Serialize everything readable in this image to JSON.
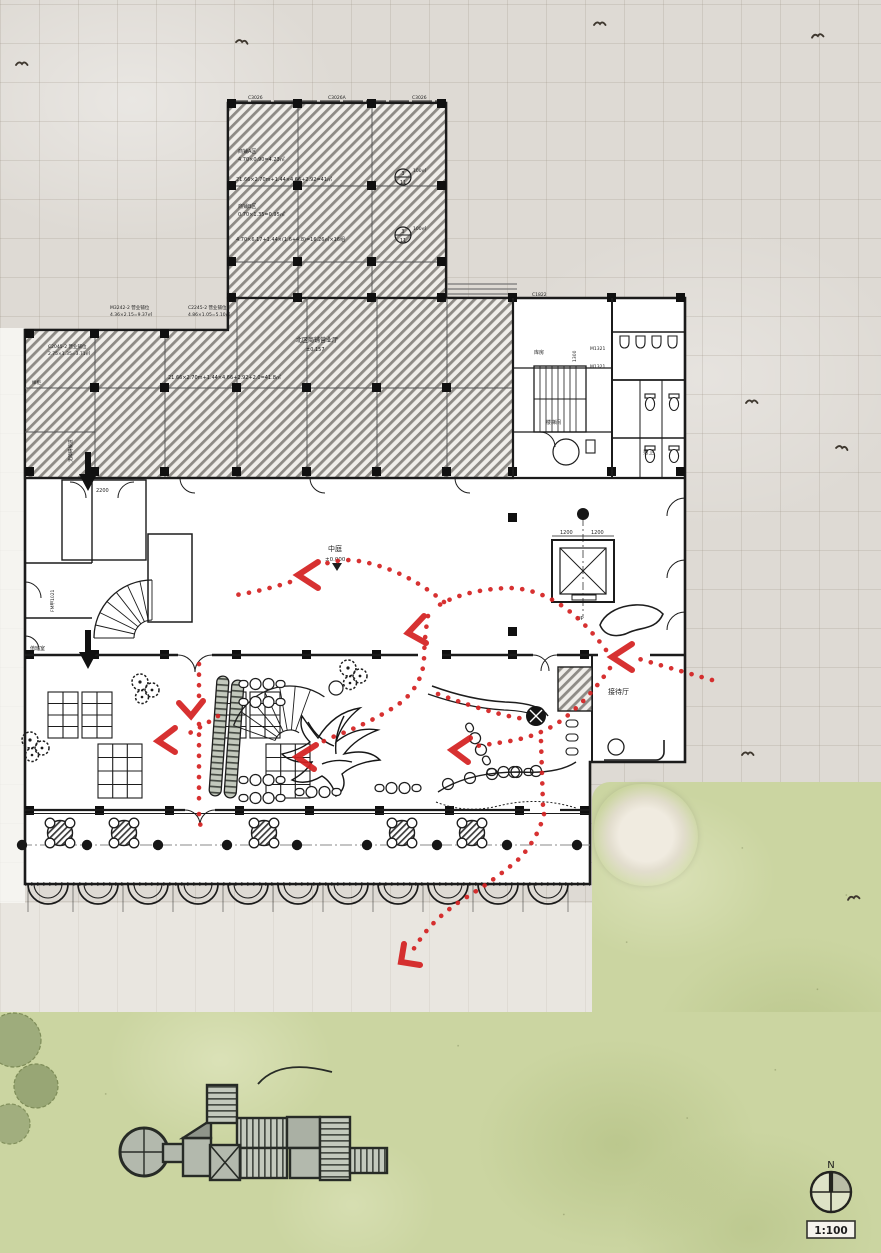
{
  "compass": {
    "north_label": "N",
    "scale_label": "1:100"
  },
  "colors": {
    "paving": "#dedad4",
    "paving_line": "#c7c1b8",
    "grass": "#cbd5a1",
    "ink": "#1b1b1b",
    "hatch_stripe": "#8e8b86",
    "path_red": "#d42222"
  },
  "rooms": {
    "atrium": "中庭",
    "atrium_level": "±0.000",
    "shop_hall": "北区商铺营业厅",
    "shop_hall_level": "±0.157",
    "reception": "接待厅",
    "male_wc": "男卫",
    "stairwell": "楼梯间",
    "storage": "库房",
    "duty_room": "值班室",
    "ramp": "无障碍坡道",
    "sample_cabinet": "样柜",
    "up": "UP"
  },
  "dims": {
    "elevator_left": "1200",
    "elevator_right": "1200",
    "vestibule": "2200",
    "wc_corridor": "1300"
  },
  "tags": {
    "window_1": "C3026",
    "window_2": "C3026A",
    "window_3": "C3026",
    "window_wing": "C1822",
    "door_wc_1": "M1321",
    "door_wc_2": "M1321",
    "fire_door": "FM甲1021"
  },
  "annotations": {
    "shop_a_name": "商铺A区",
    "shop_a_area": "4.70×0.90=4.23㎡",
    "calc_1": "21.66×2.70m+1.44×4.66+2.92=41㎡",
    "shop_b_name": "商铺B区",
    "shop_b_area": "0.70×1.35=0.95㎡",
    "calc_2": "4.70×6.17+1.44×(1.6+4.8)=16.26㎡×16组",
    "bay_1": "M3242-2 营业铺位",
    "bay_1_area": "4.36×2.15=9.37㎡",
    "bay_2": "C2245-2 营业铺位",
    "bay_2_area": "4.86×1.05=5.10㎡",
    "bay_3": "C2045-2 营业铺位",
    "bay_3_area": "2.75×1.35=3.71㎡",
    "calc_3": "21.66×2.70m+1.44×4.66+2.92+2.0=41.8㎡"
  },
  "markers": {
    "m1_num": "3",
    "m1_den": "11",
    "m1_area": "100㎡",
    "m2_num": "3",
    "m2_den": "11",
    "m2_area": "100㎡"
  }
}
